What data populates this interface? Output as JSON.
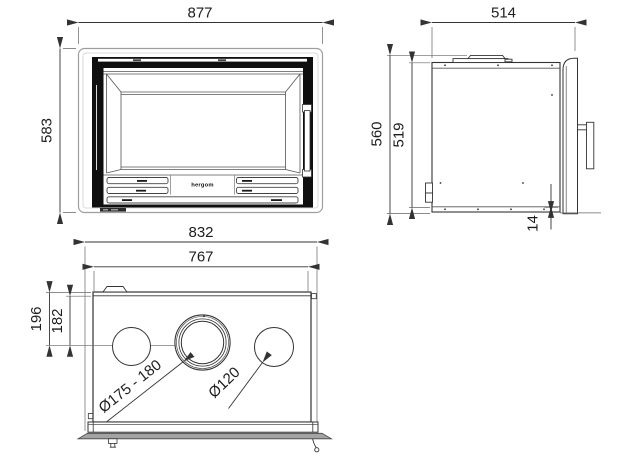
{
  "drawing": {
    "brand_label": "hergom",
    "front_view": {
      "width": "877",
      "height": "583"
    },
    "side_view": {
      "depth": "514",
      "outer_height": "560",
      "inner_height": "519",
      "base_offset": "14"
    },
    "top_view": {
      "outer_width": "832",
      "inner_width": "767",
      "outer_depth": "196",
      "inner_depth": "182",
      "flue_diameter": "Ø175 - 180",
      "outlet_diameter": "Ø120"
    },
    "colors": {
      "line": "#333333",
      "door_frame": "#0f0f0f",
      "surround_frame": "#9e9e9e",
      "trim_strip": "#a3a3a3",
      "background": "#ffffff"
    }
  }
}
